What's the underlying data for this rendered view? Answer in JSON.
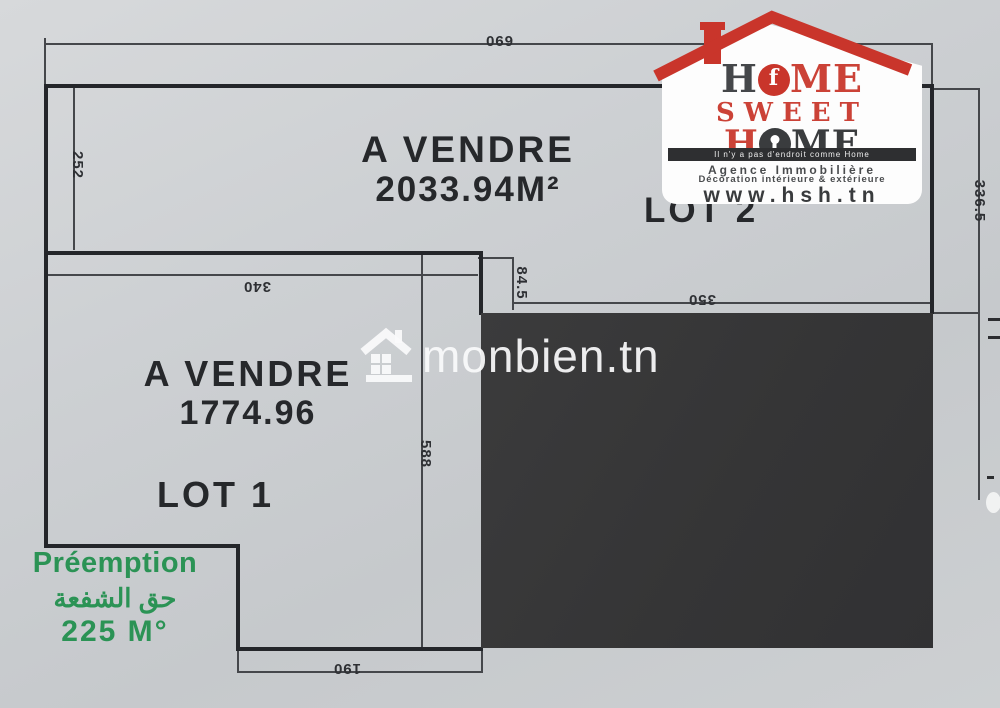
{
  "plan": {
    "lot2": {
      "sale_line1": "A VENDRE",
      "sale_line2": "2033.94M²",
      "label": "LOT 2"
    },
    "lot1": {
      "sale_line1": "A VENDRE",
      "sale_line2": "1774.96",
      "label": "LOT 1"
    },
    "preemption": {
      "line1": "Préemption",
      "line2_arabic": "حق الشفعة",
      "line3": "225 M°",
      "color": "#2b9355"
    },
    "dims": {
      "top": "690",
      "left_lot2": "252",
      "lot1_top": "340",
      "step": "84.5",
      "lot2_bottom": "350",
      "right": "336.5",
      "lot1_height": "588",
      "lot1_bottom": "190"
    }
  },
  "watermark": {
    "text": "monbien.tn",
    "icon": "house-icon"
  },
  "logo": {
    "line1_h": "H",
    "line1_o_inner": "f",
    "line1_rest": "ME",
    "line2": "SWEET",
    "line3_h": "H",
    "line3_rest": "ME",
    "tagline": "Il n'y a pas d'endroit comme Home",
    "subtitle1": "Agence Immobilière",
    "subtitle2": "Décoration intérieure & extérieure",
    "website": "www.hsh.tn",
    "colors": {
      "red": "#c9352b",
      "dark": "#3a3c3e",
      "badge": "#fdfdfd"
    }
  }
}
